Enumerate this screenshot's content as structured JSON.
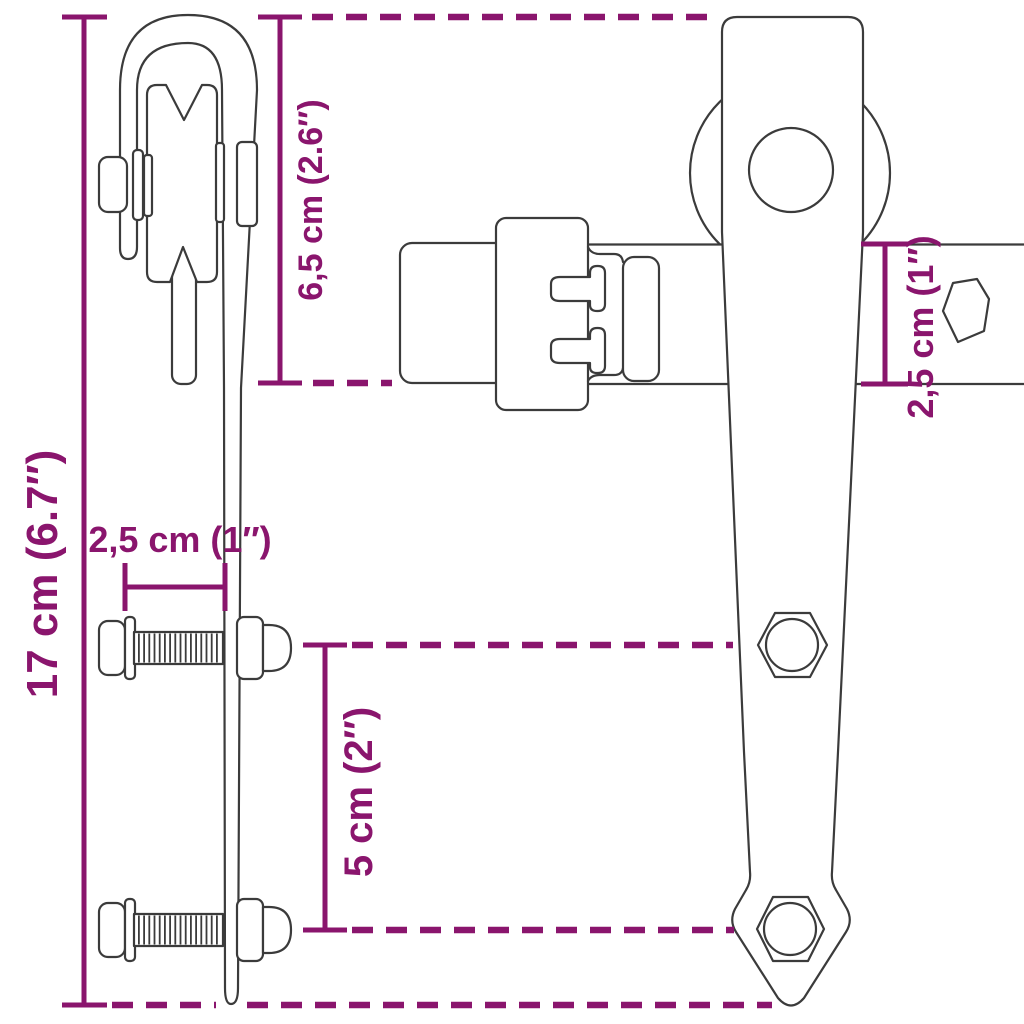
{
  "diagram": {
    "subject": "sliding-door roller hanger hardware dimension drawing",
    "background": "#ffffff",
    "line_color": "#3b3b3b",
    "accent_color": "#8a156d",
    "dims": [
      {
        "name": "total-height",
        "label": "17 cm (6.7″)",
        "value_cm": "17",
        "value_inch": "6.7",
        "orientation": "vertical"
      },
      {
        "name": "hanger-top-height",
        "label": "6,5 cm (2.6″)",
        "value_cm": "6,5",
        "value_inch": "2.6",
        "orientation": "vertical"
      },
      {
        "name": "bolt-grip-length",
        "label": "2,5 cm (1″)",
        "value_cm": "2,5",
        "value_inch": "1",
        "orientation": "horizontal"
      },
      {
        "name": "bolt-hole-spacing",
        "label": "5 cm (2″)",
        "value_cm": "5",
        "value_inch": "2",
        "orientation": "vertical"
      },
      {
        "name": "rail-height",
        "label": "2,5 cm (1″)",
        "value_cm": "2,5",
        "value_inch": "1",
        "orientation": "vertical"
      }
    ]
  }
}
